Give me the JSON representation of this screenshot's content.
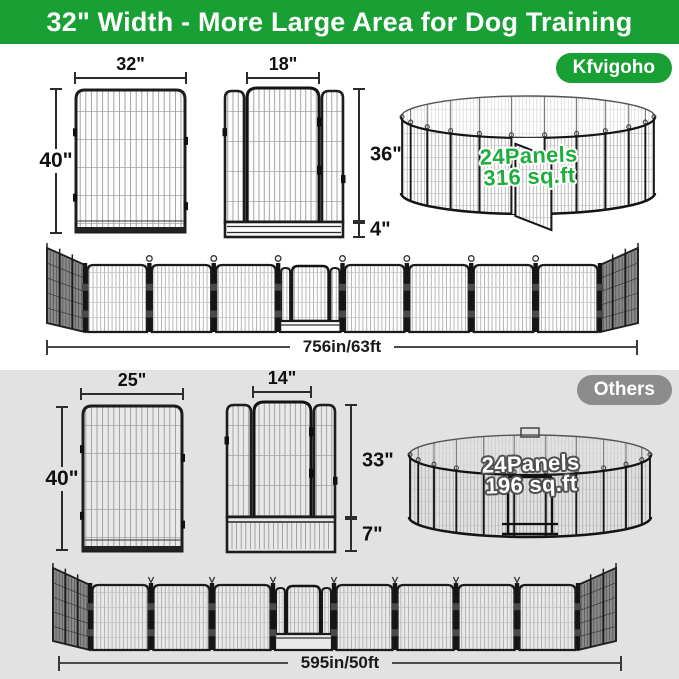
{
  "colors": {
    "brand_green": "#18a035",
    "others_gray": "#8c8c8c",
    "section_gray": "#e2e2e2",
    "pen_text_green": "#1fae3e",
    "pen_text_white": "#ffffff"
  },
  "header": {
    "title": "32\" Width - More Large Area for Dog Training"
  },
  "brand": {
    "badge": "Kfvigoho",
    "panel_width": "32\"",
    "panel_height": "40\"",
    "gate_width": "18\"",
    "gate_height": "36\"",
    "gate_gap": "4\"",
    "pen_line1": "24Panels",
    "pen_line2": "316 sq.ft",
    "row_length": "756in/63ft"
  },
  "others": {
    "badge": "Others",
    "panel_width": "25\"",
    "panel_height": "40\"",
    "gate_width": "14\"",
    "gate_height": "33\"",
    "gate_gap": "7\"",
    "pen_line1": "24Panels",
    "pen_line2": "196 sq.ft",
    "row_length": "595in/50ft"
  }
}
